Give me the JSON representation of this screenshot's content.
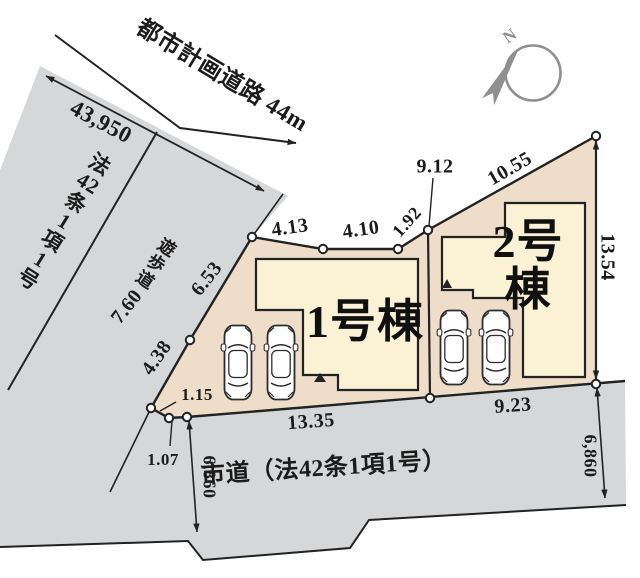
{
  "compass": {
    "north_label": "N"
  },
  "roads": {
    "planned_road_label": "都市計画道路 44m",
    "city_road_label": "市道（法42条1項1号）",
    "left_area_label": "法\n42\n条\n1\n項\n1\n号",
    "walkway_label": "遊\n歩\n道"
  },
  "buildings": {
    "lot1_label": "1号棟",
    "lot2_label": "2号棟"
  },
  "dimensions": {
    "planned_road_strip": "43,950",
    "walkway_width": "7.60",
    "west_upper": "6.53",
    "west_lower": "4.38",
    "corner_a": "1.15",
    "corner_b": "1.07",
    "north_seg1": "4.13",
    "north_seg2": "4.10",
    "north_seg3": "1.92",
    "division_line": "9.12",
    "lot2_northeast": "10.55",
    "lot2_east": "13.54",
    "lot1_south": "13.35",
    "lot2_south": "9.23",
    "road_width_left": "6,860",
    "road_width_right": "6,860"
  },
  "colors": {
    "road_gray": "#d6d7d8",
    "parcel_tan": "#eeddc8",
    "building_cream": "#fbf2d6",
    "line_dark": "#222222",
    "compass_gray": "#8f8f8f"
  }
}
